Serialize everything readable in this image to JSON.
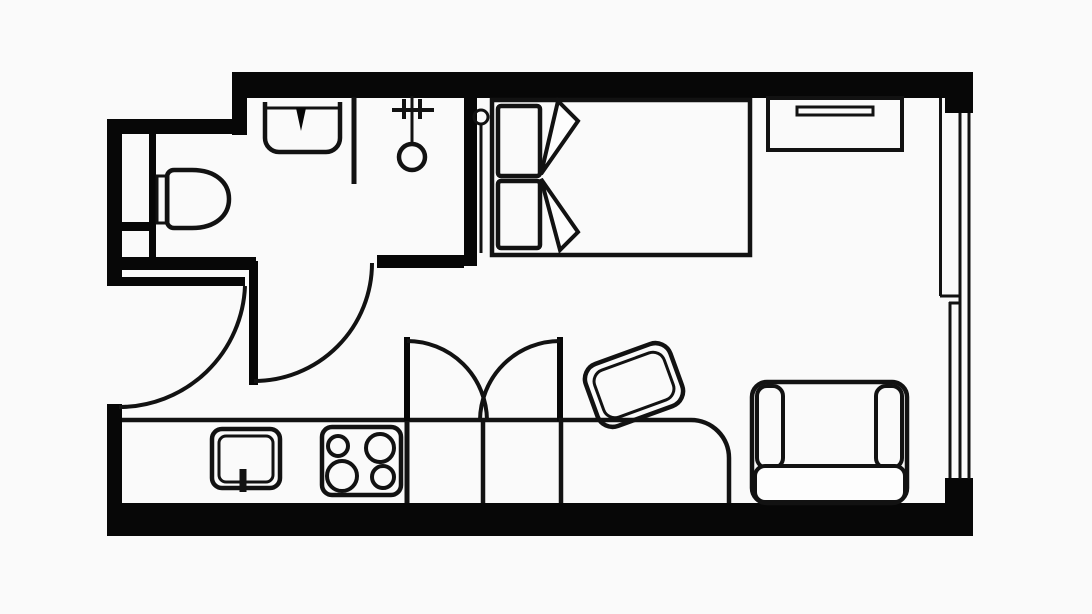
{
  "meta": {
    "title": "Studio apartment floor plan",
    "diagram_type": "architectural-floor-plan",
    "canvas": {
      "width": 1092,
      "height": 614
    }
  },
  "palette": {
    "background": "#fafafa",
    "floor": "#fdfdfd",
    "wall": "#070707",
    "line": "#121212"
  },
  "rooms": [
    {
      "id": "bathroom",
      "label": "bathroom (top-left)"
    },
    {
      "id": "entry-hall",
      "label": "entry hall (left-middle)"
    },
    {
      "id": "kitchenette",
      "label": "kitchenette (bottom-left counter run)"
    },
    {
      "id": "living-sleeping-area",
      "label": "main living / sleeping room"
    }
  ],
  "fixtures": {
    "bathroom": [
      "toilet-with-cistern",
      "wash-basin-with-drain",
      "half-height-partition",
      "hand-shower-on-wall-bracket",
      "service-duct-shaft"
    ],
    "doors": [
      "entry-door-left-wall-with-quarter-swing",
      "bathroom-door-with-quarter-swing"
    ],
    "kitchenette": [
      "counter-run",
      "kitchen-sink-with-faucet",
      "cooktop-four-burners"
    ],
    "living_sleeping_area": [
      "double-bed",
      "pillow-top",
      "pillow-bottom",
      "blanket-fold",
      "bedside-lamp-with-stem",
      "wall-shelf-desk-with-drawer-pull",
      "wardrobe-with-two-open-doors",
      "work-table-rounded-corner",
      "desk-chair-tilted",
      "armchair-two-armrests-seat-cushion"
    ],
    "window": [
      "full-height-window-right-wall-with-center-mullion"
    ]
  },
  "counts": {
    "doors": 2,
    "door_swing_arcs": 2,
    "wardrobe_door_arcs": 2,
    "windows": 1,
    "cooktop_burners": 4,
    "pillows": 2
  }
}
